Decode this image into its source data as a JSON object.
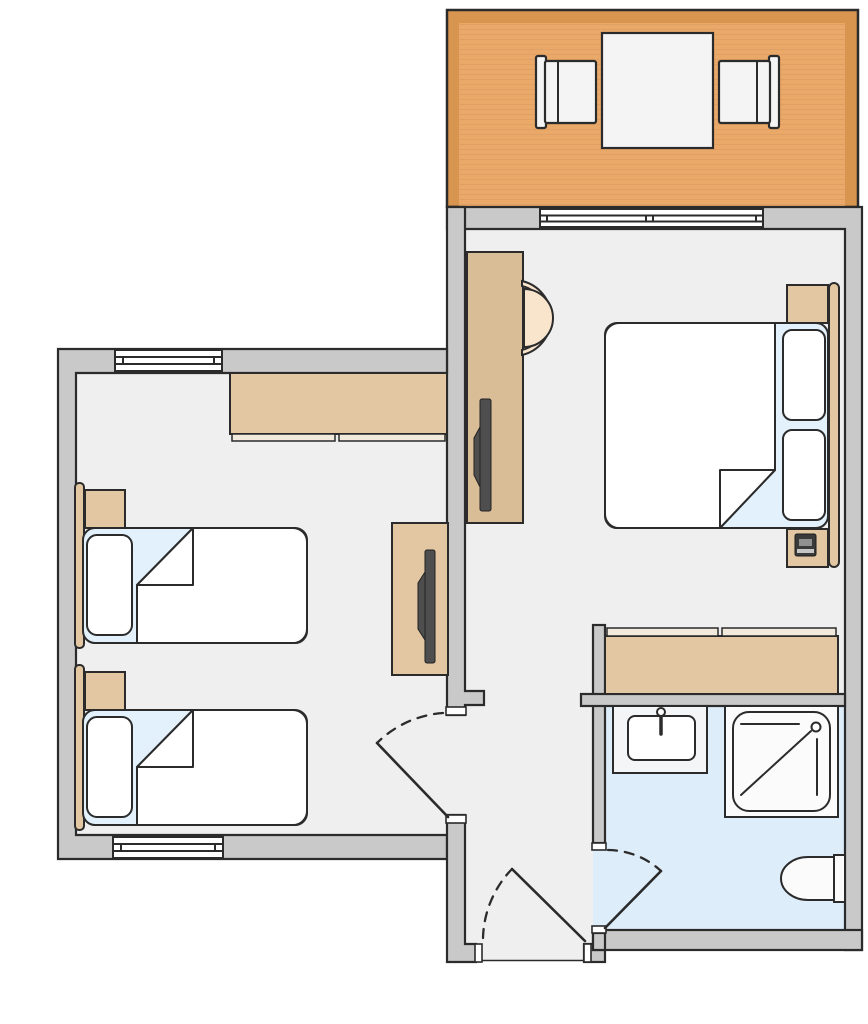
{
  "page": {
    "width": 868,
    "height": 1024,
    "type": "floor-plan",
    "background": "#FFFFFF"
  },
  "colors": {
    "page_bg": "#FFFFFF",
    "outline": "#2B2B2B",
    "wall_fill": "#C9C9C9",
    "room_floor": "#EFEFEF",
    "bathroom_floor": "#DEEDFA",
    "balcony_deck": "#EAA969",
    "balcony_border": "#D8954F",
    "furniture_tan": "#E2C7A2",
    "desk_tan": "#D9BD97",
    "rail_cream": "#F2EBDD",
    "bedding_white": "#FFFFFF",
    "sheet_blue": "#E2F1FB",
    "fixture_white": "#FBFBFB",
    "counter_white": "#F3F5F7",
    "tv_dark": "#4E4E4E",
    "chair_cream": "#F9E4CC",
    "seat_white": "#F4F4F4",
    "phone_dark": "#3A3A3A",
    "phone_band": "#909090",
    "phone_slot": "#C6C6C6"
  },
  "rooms": {
    "balcony": {
      "furniture": [
        "dining-table",
        "chair-left",
        "chair-right"
      ],
      "openings": [
        "sliding-door"
      ]
    },
    "main_bedroom": {
      "furniture": [
        "double-bed",
        "pillow-top",
        "pillow-bottom",
        "headboard",
        "nightstand-top",
        "nightstand-bottom",
        "telephone",
        "desk",
        "tv",
        "desk-chair",
        "sliding-wardrobe"
      ]
    },
    "twin_bedroom": {
      "furniture": [
        "single-bed-1",
        "single-bed-2",
        "pillow-1",
        "pillow-2",
        "headboard-1",
        "headboard-2",
        "nightstand-1",
        "nightstand-2",
        "sliding-wardrobe",
        "tv-cabinet",
        "tv"
      ],
      "openings": [
        "window-top",
        "window-bottom",
        "room-door"
      ]
    },
    "bathroom": {
      "furniture": [
        "sink",
        "shower",
        "toilet"
      ],
      "openings": [
        "bathroom-door"
      ]
    },
    "entry_corridor": {
      "openings": [
        "entry-door"
      ]
    }
  }
}
